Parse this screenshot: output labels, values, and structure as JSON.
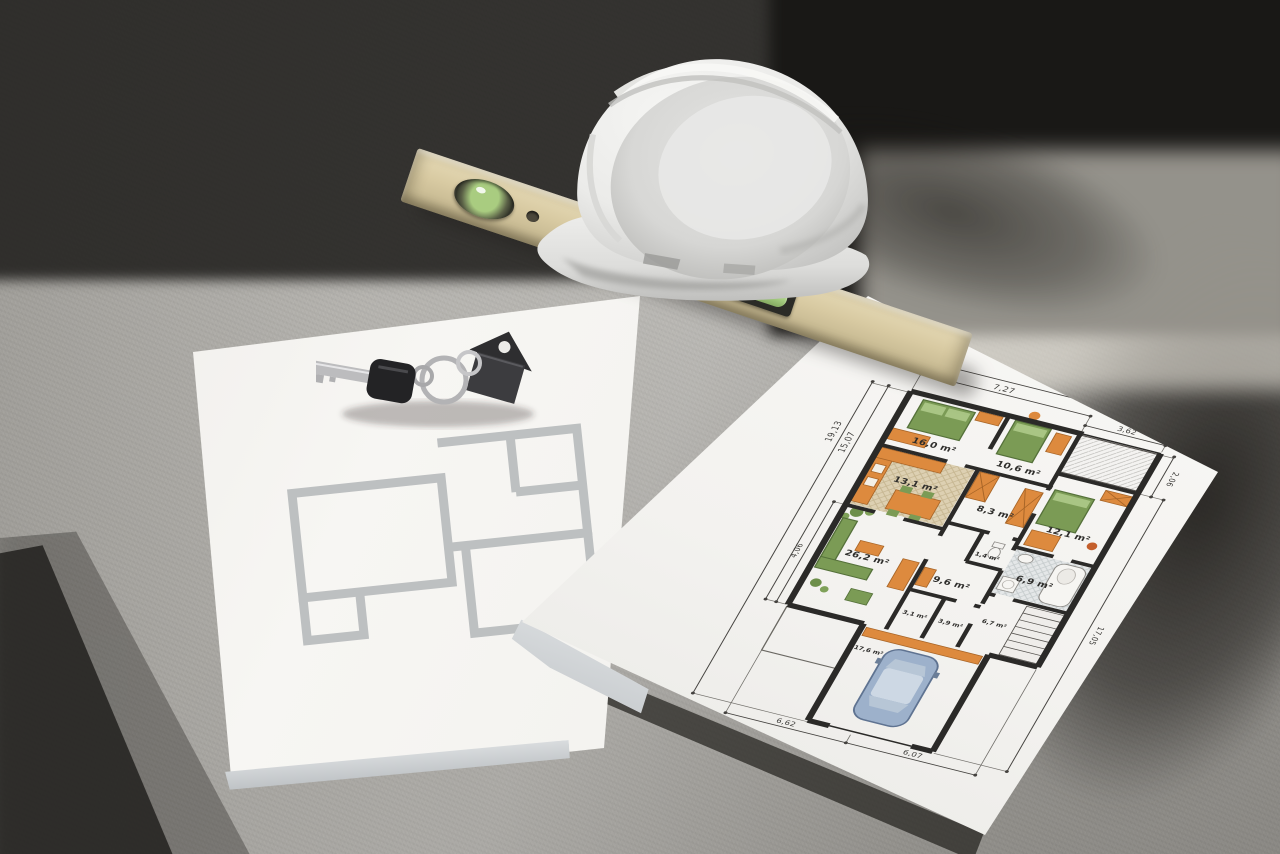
{
  "scene": {
    "description": "Construction-site concrete floor photographed in hard sunlight with diagonal shadows. A white safety hard hat rests on a wooden spirit level with green bubble vials. House keys with a house-shaped keychain lie on a sheet showing a faded gray wall-outline floor plan. A thick pad of paper shows a detailed colored architectural floor plan with room areas and dimensions.",
    "objects": [
      "hard hat",
      "spirit level",
      "keys with house-shaped keychain",
      "faded floor-plan sheet",
      "colored floor-plan pad"
    ]
  },
  "colors": {
    "concrete": "#adaba6",
    "deep_shadow": "#191816",
    "sunlit_band": "#e7e3d9",
    "paper": "#f6f5f2",
    "level_wood": "#d8caa2",
    "vial_green": "#a5cd80",
    "helmet_white": "#f2f2f0",
    "plan_wall": "#2b2a28",
    "furniture_orange": "#dd8a3e",
    "furniture_green": "#7b9b55",
    "kitchen_tile": "#ddd0b2",
    "bath_tile": "#e2e5e6",
    "car_blue": "#9db1cb",
    "gray_plan_wall": "#b4b7b9"
  },
  "colored_plan": {
    "rooms": [
      {
        "id": "bedroom-1",
        "area": "16,0 m²"
      },
      {
        "id": "bedroom-2",
        "area": "10,6 m²"
      },
      {
        "id": "kitchen",
        "area": "13,1 m²"
      },
      {
        "id": "hallway",
        "area": "8,3 m²"
      },
      {
        "id": "bedroom-3",
        "area": "12,1 m²"
      },
      {
        "id": "bathroom",
        "area": "6,9 m²"
      },
      {
        "id": "wc",
        "area": "1,4 m²"
      },
      {
        "id": "corridor",
        "area": "9,6 m²"
      },
      {
        "id": "living-room",
        "area": "26,2 m²"
      },
      {
        "id": "utility",
        "area": "6,7 m²"
      },
      {
        "id": "storage-1",
        "area": "3,1 m²"
      },
      {
        "id": "storage-2",
        "area": "3,9 m²"
      },
      {
        "id": "garage",
        "area": "17,6 m²"
      }
    ],
    "dimensions": {
      "top": [
        "7,27",
        "10,89"
      ],
      "top_right": "3,62",
      "right": [
        "2,06",
        "17,05"
      ],
      "left": [
        "19,13",
        "15,07",
        "4,06"
      ],
      "bottom": [
        "6,62",
        "6,07"
      ]
    }
  }
}
